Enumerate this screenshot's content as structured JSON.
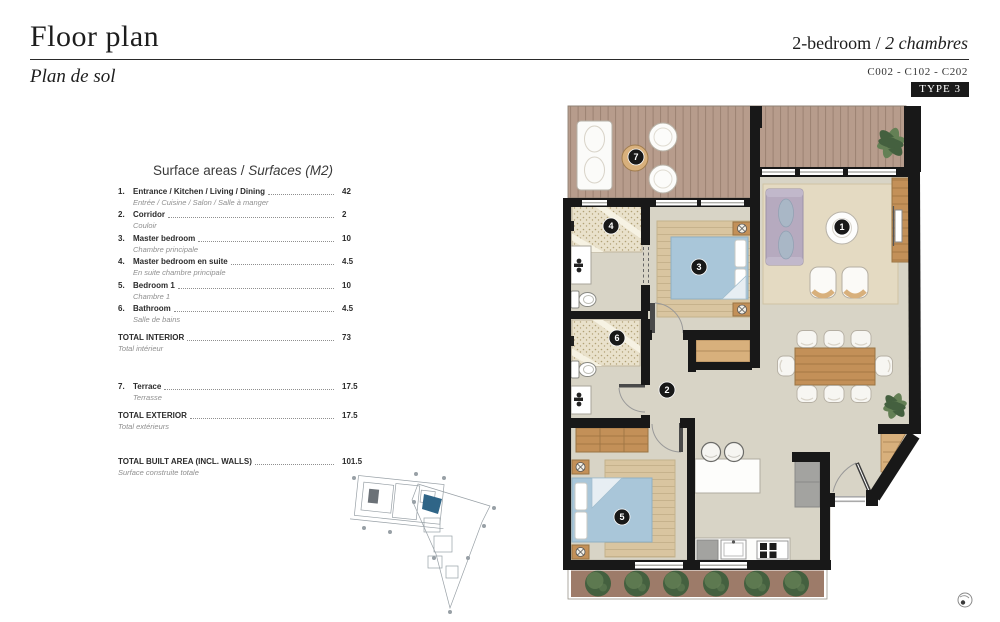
{
  "header": {
    "title": "Floor plan",
    "subtitle": "Plan de sol",
    "unit_type_en": "2-bedroom / ",
    "unit_type_fr": "2 chambres",
    "unit_codes": "C002 - C102 - C202",
    "type_badge": "TYPE 3"
  },
  "surface_table": {
    "heading_en": "Surface areas / ",
    "heading_fr": "Surfaces (M2)",
    "rows": [
      {
        "kind": "item",
        "num": "1.",
        "en": "Entrance / Kitchen / Living / Dining",
        "fr": "Entrée / Cuisine / Salon / Salle à manger",
        "value": "42",
        "gap": ""
      },
      {
        "kind": "item",
        "num": "2.",
        "en": "Corridor",
        "fr": "Couloir",
        "value": "2",
        "gap": ""
      },
      {
        "kind": "item",
        "num": "3.",
        "en": "Master bedroom",
        "fr": "Chambre principale",
        "value": "10",
        "gap": ""
      },
      {
        "kind": "item",
        "num": "4.",
        "en": "Master bedroom en suite",
        "fr": "En suite chambre principale",
        "value": "4.5",
        "gap": ""
      },
      {
        "kind": "item",
        "num": "5.",
        "en": "Bedroom 1",
        "fr": "Chambre 1",
        "value": "10",
        "gap": ""
      },
      {
        "kind": "item",
        "num": "6.",
        "en": "Bathroom",
        "fr": "Salle de bains",
        "value": "4.5",
        "gap": ""
      },
      {
        "kind": "total",
        "num": "",
        "en": "TOTAL INTERIOR",
        "fr": "Total intérieur",
        "value": "73",
        "gap": "sm"
      },
      {
        "kind": "item",
        "num": "7.",
        "en": "Terrace",
        "fr": "Terrasse",
        "value": "17.5",
        "gap": "lg"
      },
      {
        "kind": "total",
        "num": "",
        "en": "TOTAL EXTERIOR",
        "fr": "Total extérieurs",
        "value": "17.5",
        "gap": "sm"
      },
      {
        "kind": "total",
        "num": "",
        "en": "TOTAL BUILT AREA (INCL. WALLS)",
        "fr": "Surface construite totale",
        "value": "101.5",
        "gap": "xl"
      }
    ]
  },
  "floor_plan": {
    "room_markers": [
      {
        "number": "1",
        "x": 842,
        "y": 227
      },
      {
        "number": "2",
        "x": 667,
        "y": 390
      },
      {
        "number": "3",
        "x": 699,
        "y": 267
      },
      {
        "number": "4",
        "x": 611,
        "y": 226
      },
      {
        "number": "5",
        "x": 622,
        "y": 517
      },
      {
        "number": "6",
        "x": 617,
        "y": 338
      },
      {
        "number": "7",
        "x": 636,
        "y": 157
      }
    ],
    "colors": {
      "accent": "#1a1a1a",
      "wall": "#181818",
      "floor": "#d8d4c6",
      "deck": "#b79c8c",
      "deck_line": "#9b8171",
      "rug_living": "#e4dac2",
      "rug_tan": "#d9c5a0",
      "bed_blue": "#a9c6d9",
      "bed_fold": "#e7eef3",
      "sofa": "#b6aabf",
      "cushion": "#a9b7c6",
      "wood": "#c39058",
      "wood_light": "#d8b07c",
      "speckle_bg": "#e9e1cb",
      "speckle_dot": "#b1a176",
      "appliance_gray": "#a3a3a0",
      "planter_soil": "#9d7b69",
      "bush_dark": "#44603f",
      "bush_light": "#648055",
      "site_line": "#98a0a6",
      "site_highlight": "#2f6587"
    }
  }
}
